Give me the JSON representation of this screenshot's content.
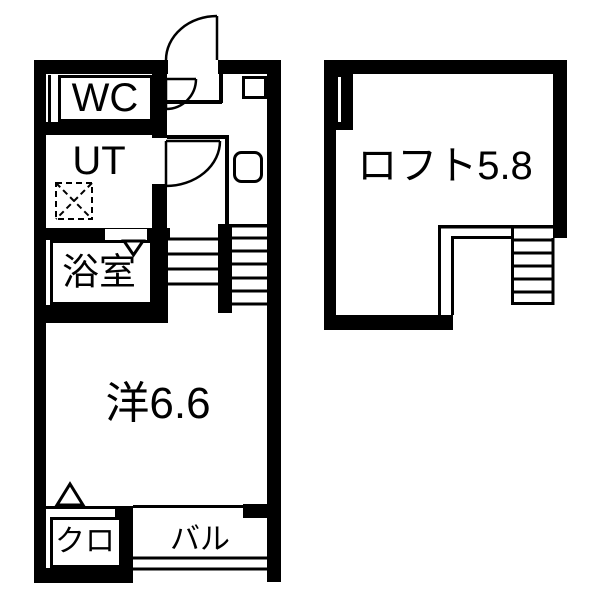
{
  "palette": {
    "wall": "#000000",
    "floor": "#ffffff"
  },
  "rooms": {
    "wc": {
      "label": "WC"
    },
    "ut": {
      "label": "UT"
    },
    "bath": {
      "label": "浴室"
    },
    "western": {
      "label": "洋6.6"
    },
    "closet": {
      "label": "クロ"
    },
    "balcony": {
      "label": "バル"
    },
    "loft": {
      "label": "ロフト5.8"
    }
  },
  "icons": {
    "door_swing": "quarter-arc door swing",
    "folding_door_arrow": "triangle arrow",
    "washer_space": "dashed square with X",
    "stairs": "parallel tread lines",
    "window": "thin double line in wall"
  }
}
